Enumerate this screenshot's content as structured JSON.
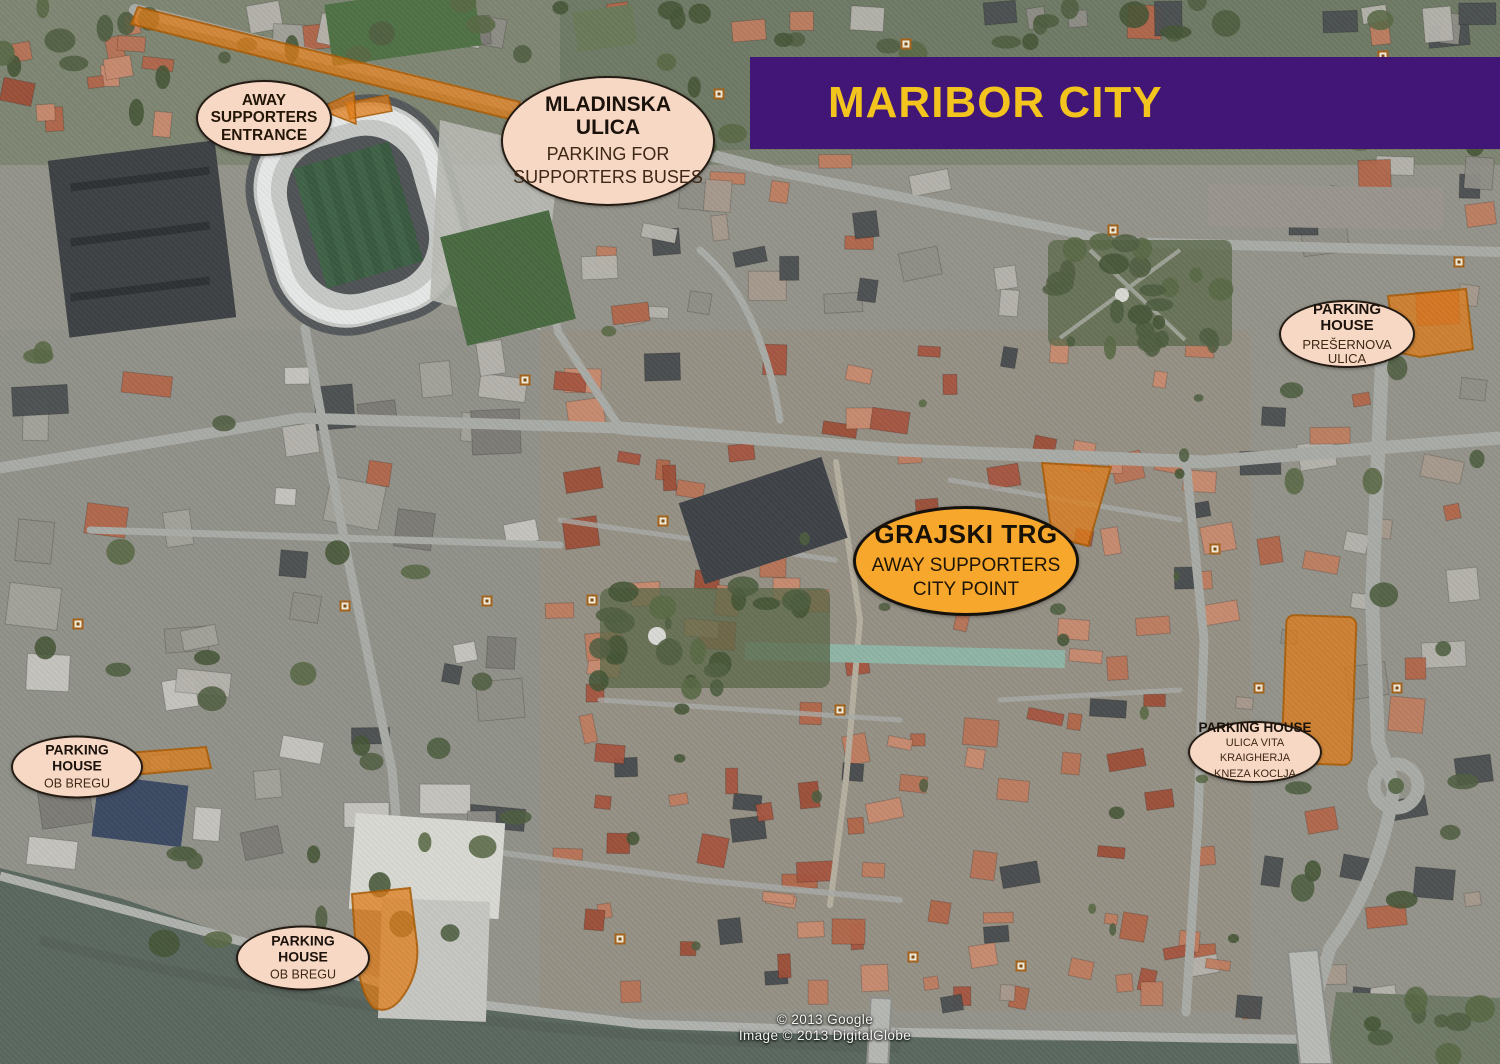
{
  "banner": {
    "title": "MARIBOR CITY",
    "bg_color": "#411677",
    "text_color": "#f2c41d"
  },
  "labels": {
    "away_entrance": {
      "line1": "AWAY",
      "line2": "SUPPORTERS",
      "line3": "ENTRANCE"
    },
    "mladinska": {
      "title": "MLADINSKA ULICA",
      "line1": "PARKING FOR",
      "line2": "SUPPORTERS BUSES"
    },
    "presernova": {
      "title": "PARKING HOUSE",
      "line1": "PREŠERNOVA ULICA"
    },
    "grajski": {
      "title": "GRAJSKI TRG",
      "line1": "AWAY SUPPORTERS",
      "line2": "CITY POINT"
    },
    "kraigherja": {
      "title": "PARKING HOUSE",
      "line1": "ULICA VITA KRAIGHERJA",
      "line2": "KNEZA KOCLJA"
    },
    "ob_bregu_north": {
      "title": "PARKING HOUSE",
      "line1": "OB BREGU"
    },
    "ob_bregu_south": {
      "title": "PARKING HOUSE",
      "line1": "OB BREGU"
    }
  },
  "attribution": {
    "line1": "© 2013 Google",
    "line2": "Image © 2013 DigitalGlobe"
  },
  "map_style": {
    "highlight_color": "#e07c17",
    "label_fill": "#f6d8c4",
    "accent_oval_fill": "#f7a72b",
    "water_color": "#5b6860"
  }
}
